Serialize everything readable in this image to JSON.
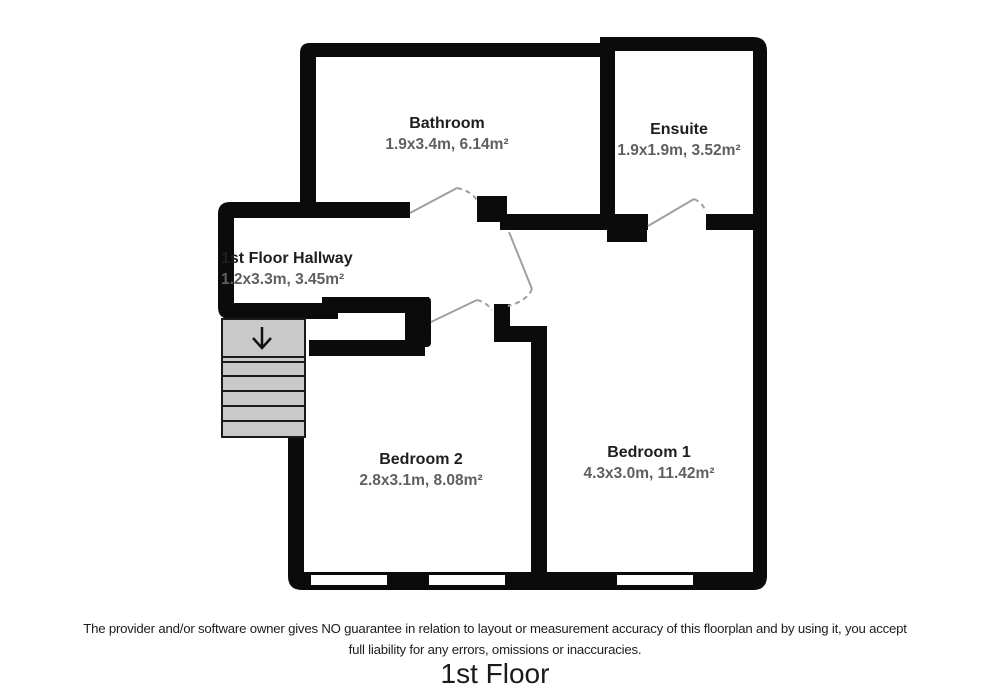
{
  "floorplan": {
    "title": "1st Floor",
    "disclaimer": {
      "line1": "The provider and/or software owner gives NO guarantee in relation to layout or measurement accuracy of this floorplan and by using it, you accept",
      "line2": "full liability for any errors, omissions or inaccuracies."
    },
    "rooms": [
      {
        "name": "Bathroom",
        "dimensions": "1.9x3.4m, 6.14m²"
      },
      {
        "name": "Ensuite",
        "dimensions": "1.9x1.9m, 3.52m²"
      },
      {
        "name": "1st Floor Hallway",
        "dimensions": "1.2x3.3m, 3.45m²"
      },
      {
        "name": "Bedroom 2",
        "dimensions": "2.8x3.1m, 8.08m²"
      },
      {
        "name": "Bedroom 1",
        "dimensions": "4.3x3.0m, 11.42m²"
      }
    ],
    "stairs": {
      "direction_icon": "down-arrow"
    },
    "colors": {
      "wall": "#0b0b0b",
      "stairs_fill": "#c9c9c9",
      "stairs_line": "#1a1a1a",
      "door_swing": "#98a2a4",
      "room_name_text": "#1f1f1f",
      "room_dims_text": "#5f5f5f",
      "window_fill": "#ffffff"
    }
  }
}
